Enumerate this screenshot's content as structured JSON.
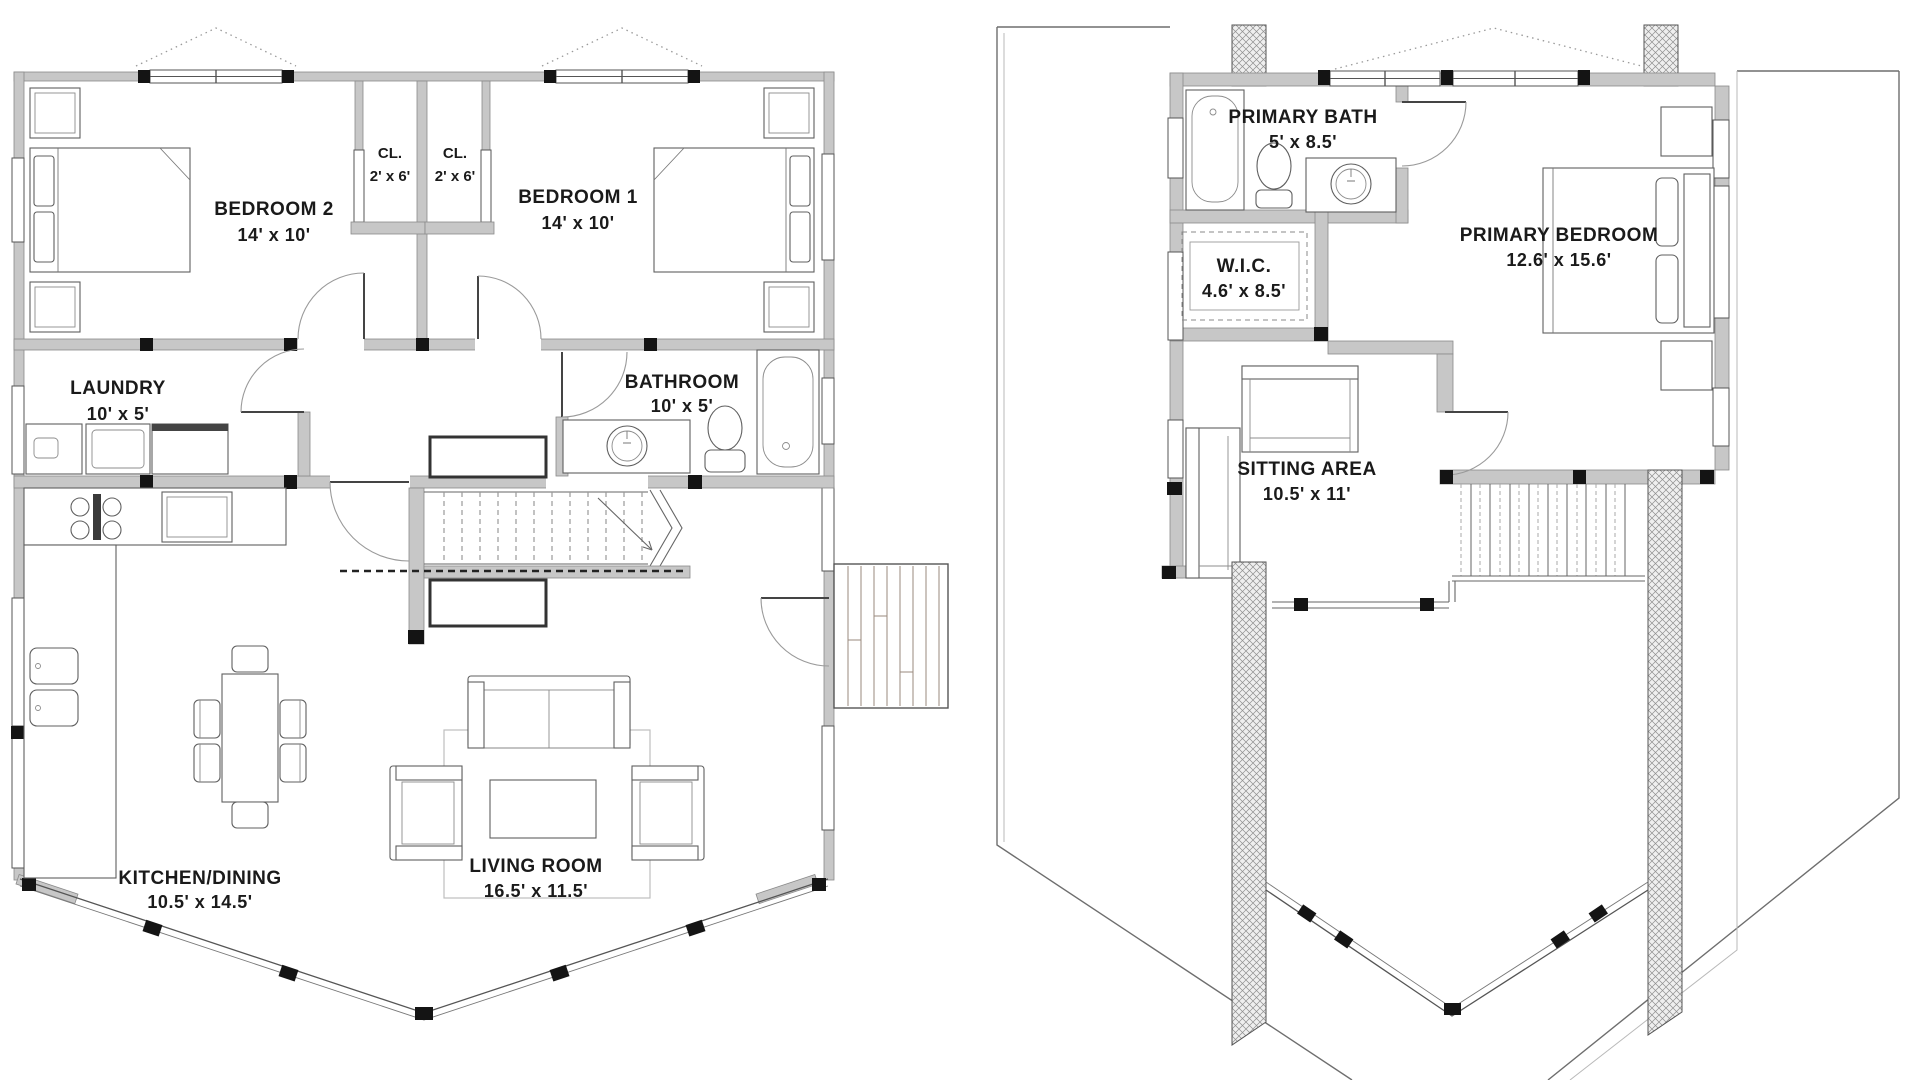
{
  "drawing": {
    "kind": "house floor plans, two levels, prow-front chalet"
  },
  "first_floor": {
    "rooms": [
      {
        "id": "bedroom2",
        "name": "BEDROOM 2",
        "dims": "14' x 10'"
      },
      {
        "id": "closet_left",
        "name": "CL.",
        "dims": "2' x 6'"
      },
      {
        "id": "closet_right",
        "name": "CL.",
        "dims": "2' x 6'"
      },
      {
        "id": "bedroom1",
        "name": "BEDROOM 1",
        "dims": "14' x 10'"
      },
      {
        "id": "laundry",
        "name": "LAUNDRY",
        "dims": "10' x 5'"
      },
      {
        "id": "bathroom",
        "name": "BATHROOM",
        "dims": "10' x 5'"
      },
      {
        "id": "kitchen_dining",
        "name": "KITCHEN/DINING",
        "dims": "10.5' x 14.5'"
      },
      {
        "id": "living_room",
        "name": "LIVING ROOM",
        "dims": "16.5' x 11.5'"
      }
    ]
  },
  "second_floor": {
    "rooms": [
      {
        "id": "primary_bath",
        "name": "PRIMARY BATH",
        "dims": "5' x 8.5'"
      },
      {
        "id": "wic",
        "name": "W.I.C.",
        "dims": "4.6' x 8.5'"
      },
      {
        "id": "primary_bedroom",
        "name": "PRIMARY BEDROOM",
        "dims": "12.6' x 15.6'"
      },
      {
        "id": "sitting_area",
        "name": "SITTING AREA",
        "dims": "10.5' x 11'"
      }
    ]
  },
  "colors": {
    "wall_fill": "#c7c7c7",
    "wall_stroke": "#8a8a8a",
    "post": "#141414",
    "line": "#666666",
    "deck_plank": "#9a8a7e",
    "text": "#1a1a1a",
    "background": "#ffffff"
  }
}
